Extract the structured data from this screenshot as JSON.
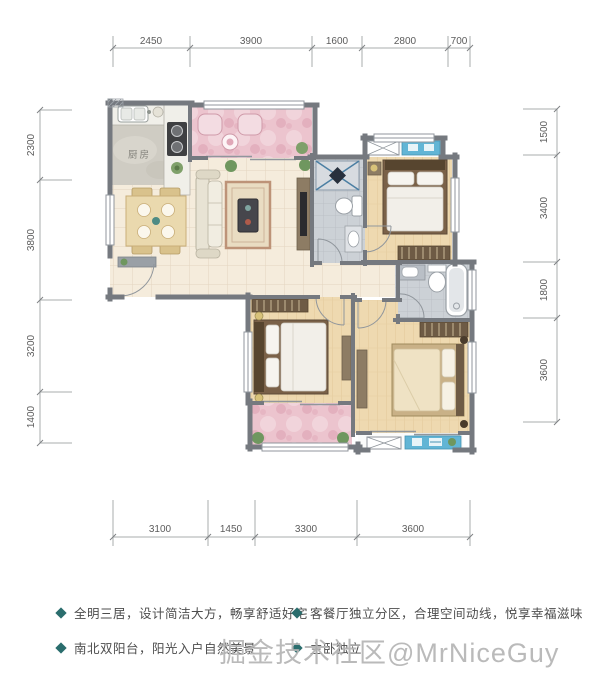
{
  "floorplan": {
    "kitchen_label": "厨房",
    "dimensions_top": [
      "2450",
      "3900",
      "1600",
      "2800",
      "700"
    ],
    "dimensions_bottom": [
      "3100",
      "1450",
      "3300",
      "3600"
    ],
    "dimensions_left": [
      "2300",
      "3800",
      "3200",
      "1400"
    ],
    "dimensions_right": [
      "1500",
      "3400",
      "1800",
      "3600"
    ]
  },
  "features": [
    "全明三居，设计简洁大方，畅享舒适好宅",
    "南北双阳台，阳光入户自然美景",
    "客餐厅独立分区，合理空间动线，悦享幸福滋味",
    "主卧独立"
  ],
  "watermark": "掘金技术社区@MrNiceGuy",
  "colors": {
    "wall": "#75797f",
    "living_tile": "#f5ecdc",
    "wood_floor": "#eed9b0",
    "balcony_pink": "#ecc4ce",
    "bath_tile": "#ccd1d6",
    "kitchen_marble": "#cfccc3",
    "desk_blue": "#62b5d5",
    "bullet_teal": "#2a6d6d",
    "watermark_gray": "#b5b5b5"
  }
}
